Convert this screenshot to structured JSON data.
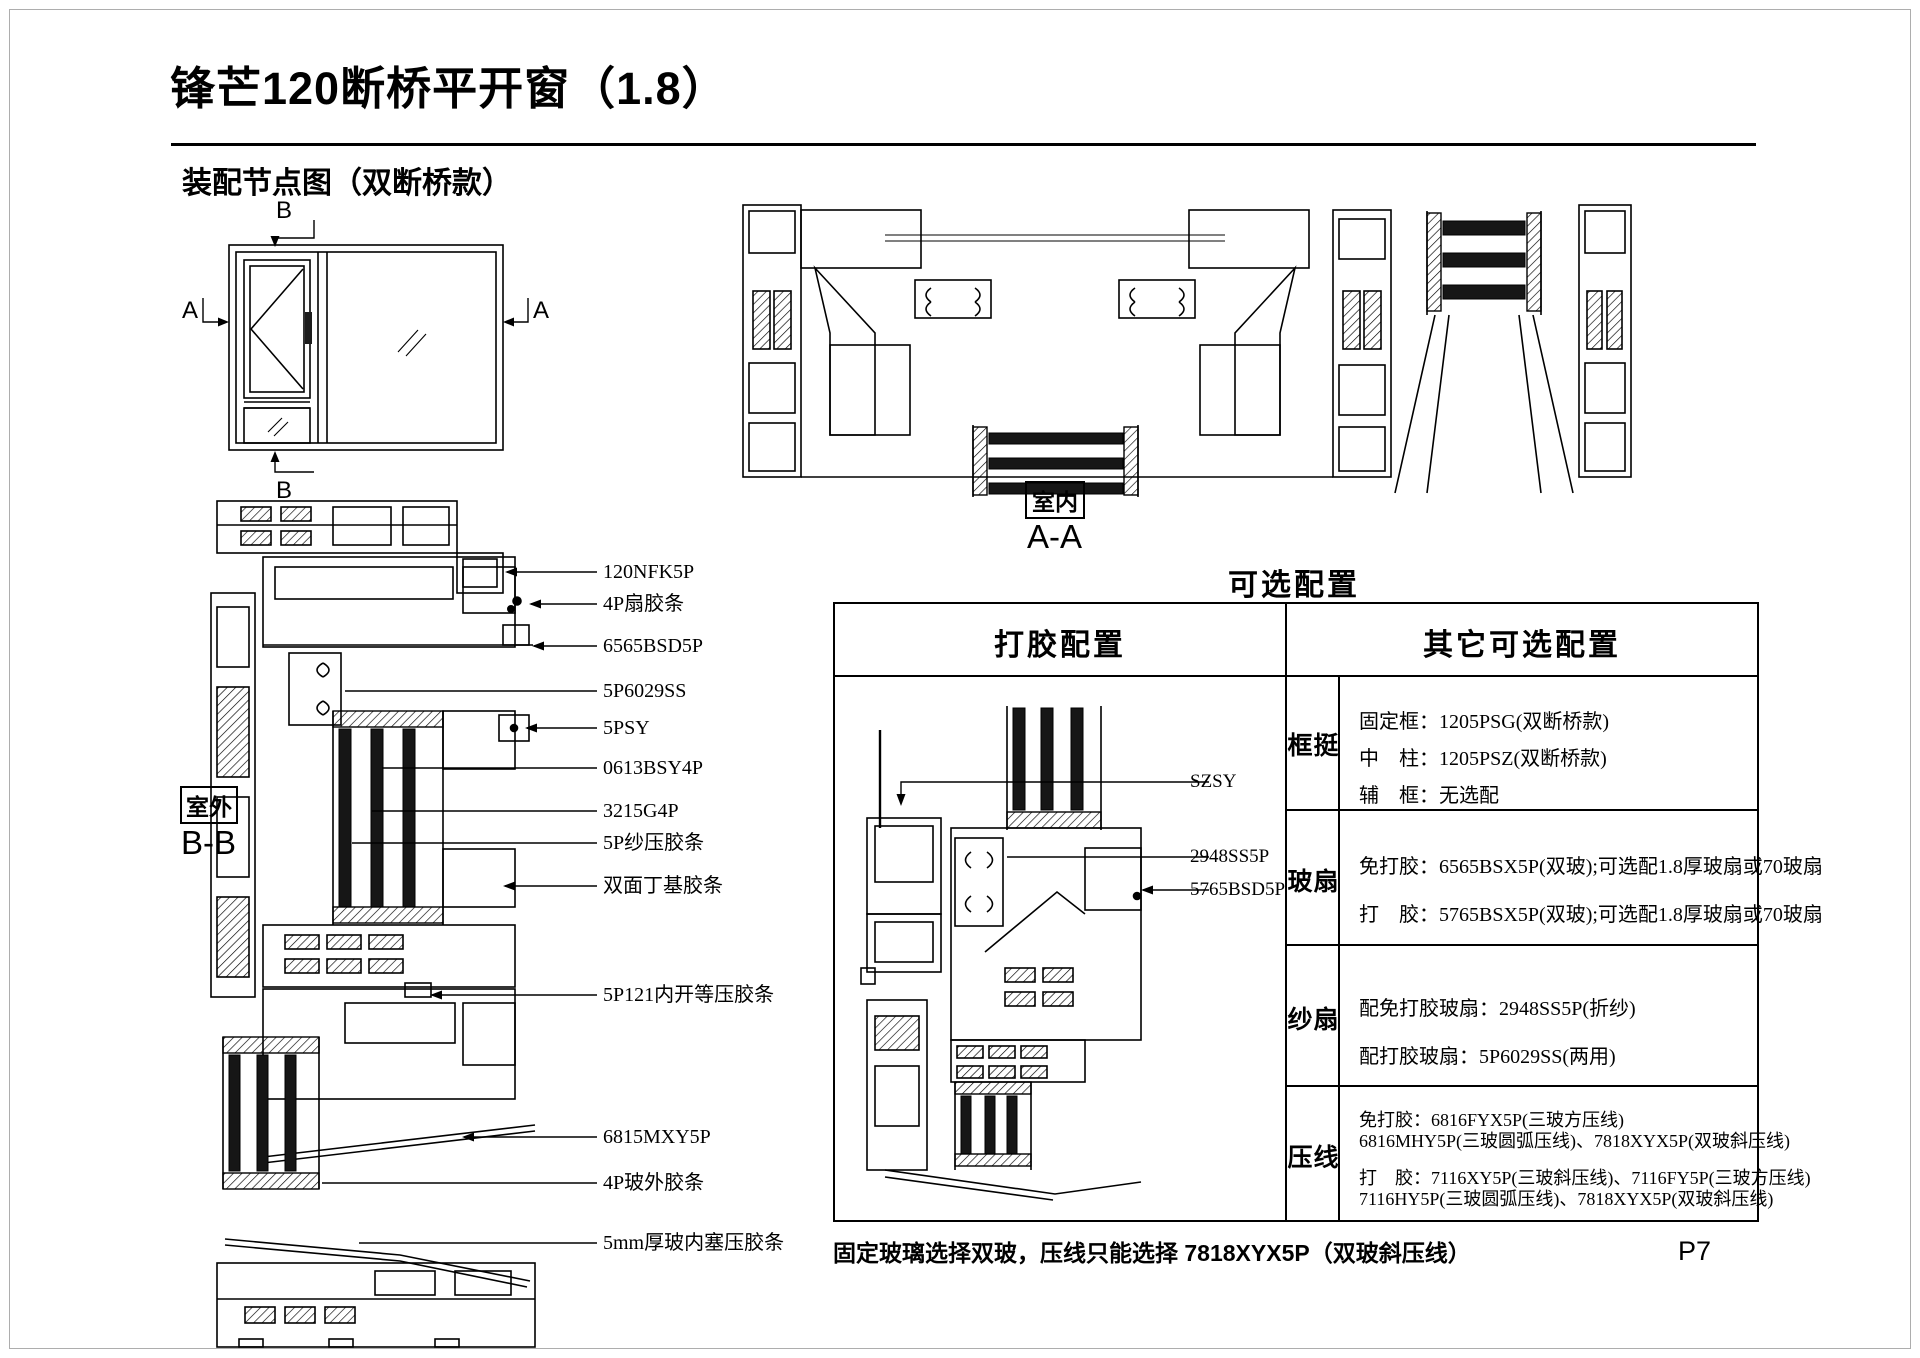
{
  "page": {
    "title": "锋芒120断桥平开窗（1.8）",
    "subtitle": "装配节点图（双断桥款）",
    "footnote": "固定玻璃选择双玻，压线只能选择 7818XYX5P（双玻斜压线）",
    "page_number": "P7"
  },
  "elevation": {
    "marker_a": "A",
    "marker_b": "B"
  },
  "section_bb": {
    "name": "B-B",
    "side_label": "室外",
    "labels": [
      "120NFK5P",
      "4P扇胶条",
      "6565BSD5P",
      "5P6029SS",
      "5PSY",
      "0613BSY4P",
      "3215G4P",
      "5P纱压胶条",
      "双面丁基胶条",
      "5P121内开等压胶条",
      "6815MXY5P",
      "4P玻外胶条",
      "5mm厚玻内塞压胶条"
    ]
  },
  "section_aa": {
    "name": "A-A",
    "side_label": "室内"
  },
  "options_table": {
    "title": "可选配置",
    "col1_header": "打胶配置",
    "col2_header": "其它可选配置",
    "diagram_labels": [
      "SZSY",
      "2948SS5P",
      "5765BSD5P"
    ],
    "rows": [
      {
        "label": "框挺",
        "lines": [
          "固定框：1205PSG(双断桥款)",
          "中　柱：1205PSZ(双断桥款)",
          "辅　框：无选配"
        ]
      },
      {
        "label": "玻扇",
        "lines": [
          "免打胶：6565BSX5P(双玻);可选配1.8厚玻扇或70玻扇",
          "打　胶：5765BSX5P(双玻);可选配1.8厚玻扇或70玻扇"
        ]
      },
      {
        "label": "纱扇",
        "lines": [
          "配免打胶玻扇：2948SS5P(折纱)",
          "配打胶玻扇：5P6029SS(两用)"
        ]
      },
      {
        "label": "压线",
        "lines": [
          "免打胶：6816FYX5P(三玻方压线)",
          "6816MHY5P(三玻圆弧压线)、7818XYX5P(双玻斜压线)",
          "打　胶：7116XY5P(三玻斜压线)、7116FY5P(三玻方压线)",
          "7116HY5P(三玻圆弧压线)、7818XYX5P(双玻斜压线)"
        ]
      }
    ]
  }
}
